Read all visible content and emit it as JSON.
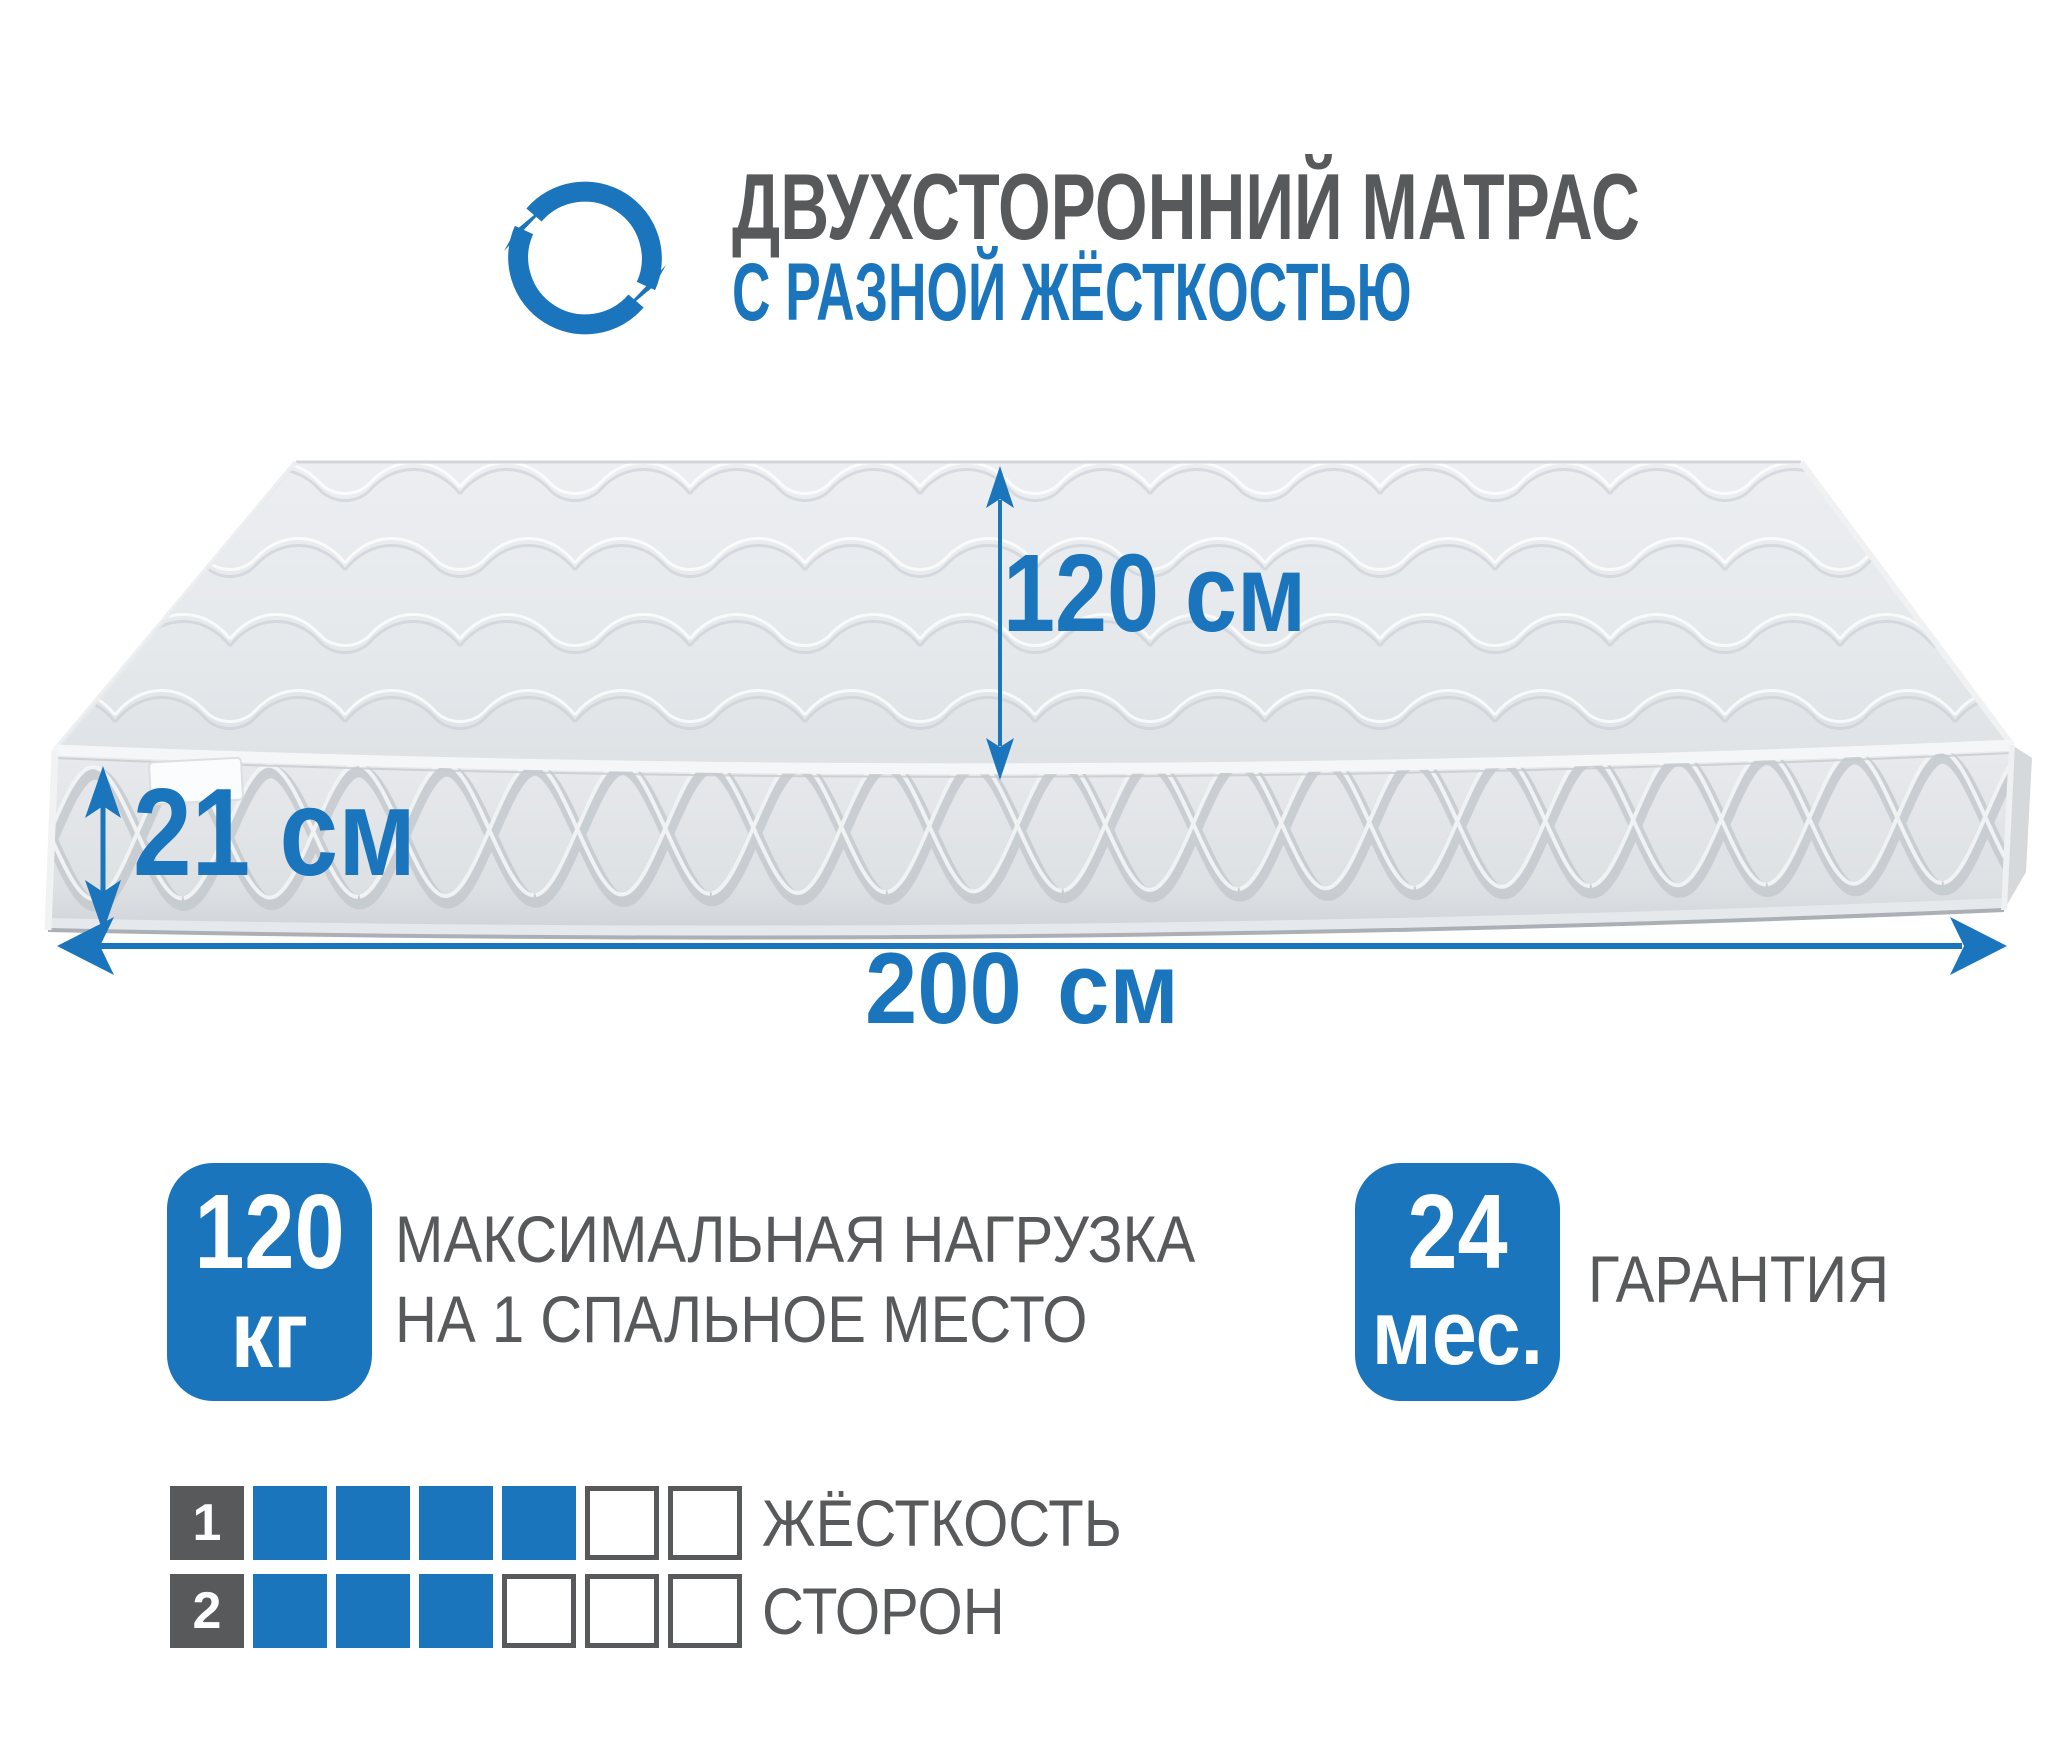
{
  "header": {
    "icon": "rotate-arrows-icon",
    "title": "ДВУХСТОРОННИЙ МАТРАС",
    "subtitle": "С РАЗНОЙ ЖЁСТКОСТЬЮ"
  },
  "dimensions": {
    "width_label": "120 см",
    "thickness_label": "21 см",
    "length_label": "200 см"
  },
  "badges": {
    "max_load": {
      "value": "120",
      "unit": "кг",
      "caption_line1": "МАКСИМАЛЬНАЯ НАГРУЗКА",
      "caption_line2": "НА 1 СПАЛЬНОЕ МЕСТО"
    },
    "warranty": {
      "value": "24",
      "unit": "мес.",
      "caption": "ГАРАНТИЯ"
    }
  },
  "hardness_scale": {
    "caption_line1": "ЖЁСТКОСТЬ",
    "caption_line2": "СТОРОН",
    "cells_total": 6,
    "rows": [
      {
        "side_label": "1",
        "filled_cells": 4
      },
      {
        "side_label": "2",
        "filled_cells": 3
      }
    ]
  },
  "colors": {
    "accent_blue": "#1b75bc",
    "text_gray": "#58595b"
  }
}
